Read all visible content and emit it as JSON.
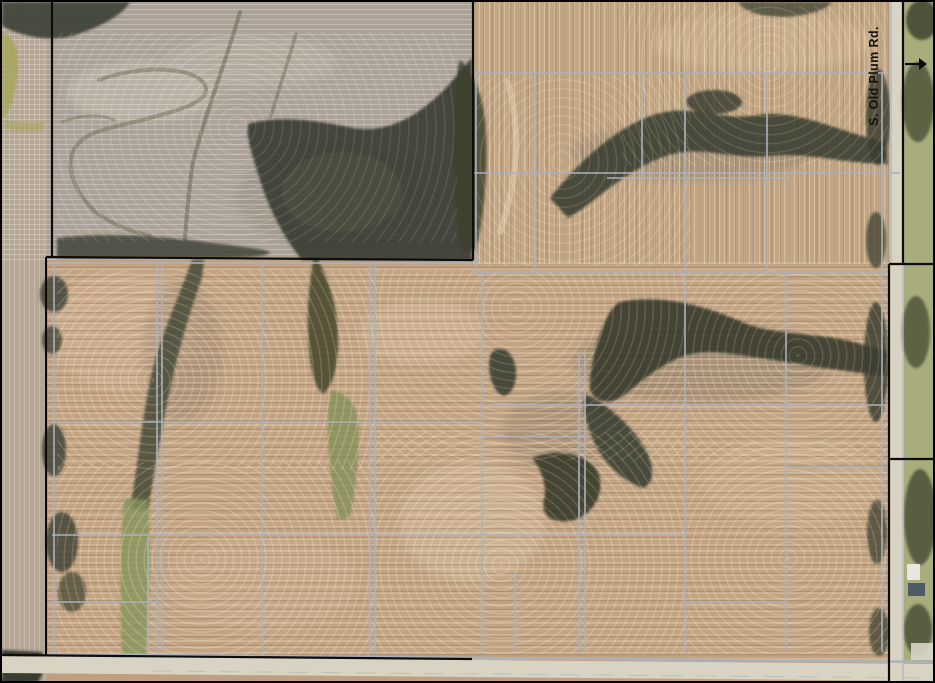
{
  "map": {
    "road_label": "S. Old Plum Rd.",
    "arrow_direction": "east"
  },
  "colors": {
    "field_brown": "#bf9f7f",
    "field_gray": "#aca297",
    "trees_dark": "#3c4033",
    "waterway_green": "#7e8d55",
    "roadside_grass": "#a9ad7c",
    "road_pavement": "#d8d3c2",
    "tile_line_gray": "#aab2be",
    "boundary_black": "#0d0d0d"
  },
  "overlay": {
    "gray_segments": [
      [
        52,
        260,
        52,
        652
      ],
      [
        146,
        535,
        146,
        650
      ],
      [
        155,
        262,
        155,
        650
      ],
      [
        160,
        262,
        160,
        650
      ],
      [
        260,
        262,
        260,
        650
      ],
      [
        368,
        262,
        368,
        652
      ],
      [
        373,
        262,
        373,
        652
      ],
      [
        474,
        71,
        474,
        270
      ],
      [
        480,
        270,
        480,
        652
      ],
      [
        513,
        570,
        513,
        650
      ],
      [
        533,
        71,
        533,
        268
      ],
      [
        577,
        352,
        577,
        652
      ],
      [
        583,
        352,
        583,
        652
      ],
      [
        640,
        71,
        640,
        176
      ],
      [
        683,
        71,
        683,
        650
      ],
      [
        765,
        71,
        765,
        270
      ],
      [
        784,
        270,
        784,
        650
      ],
      [
        880,
        71,
        880,
        650
      ],
      [
        471,
        71,
        886,
        71
      ],
      [
        471,
        171,
        898,
        171
      ],
      [
        605,
        176,
        788,
        176
      ],
      [
        683,
        171,
        683,
        176
      ],
      [
        765,
        171,
        765,
        176
      ],
      [
        45,
        261,
        471,
        261
      ],
      [
        471,
        270,
        886,
        270
      ],
      [
        487,
        403,
        886,
        403
      ],
      [
        482,
        435,
        586,
        435
      ],
      [
        50,
        420,
        478,
        420
      ],
      [
        50,
        533,
        683,
        533
      ],
      [
        50,
        600,
        157,
        600
      ],
      [
        683,
        600,
        784,
        600
      ],
      [
        784,
        465,
        886,
        465
      ],
      [
        45,
        652,
        935,
        660,
        2.4
      ],
      [
        889,
        0,
        889,
        262,
        1.2
      ],
      [
        901,
        262,
        901,
        680,
        1.2
      ]
    ],
    "black_segments": [
      [
        50,
        0,
        50,
        255
      ],
      [
        44,
        255,
        44,
        653
      ],
      [
        44,
        255,
        471,
        258
      ],
      [
        471,
        0,
        471,
        258
      ],
      [
        901,
        0,
        901,
        262
      ],
      [
        887,
        262,
        887,
        679
      ],
      [
        887,
        262,
        935,
        262
      ],
      [
        887,
        457,
        935,
        457
      ],
      [
        903,
        62,
        917,
        62
      ],
      [
        0,
        653,
        470,
        657
      ]
    ]
  }
}
